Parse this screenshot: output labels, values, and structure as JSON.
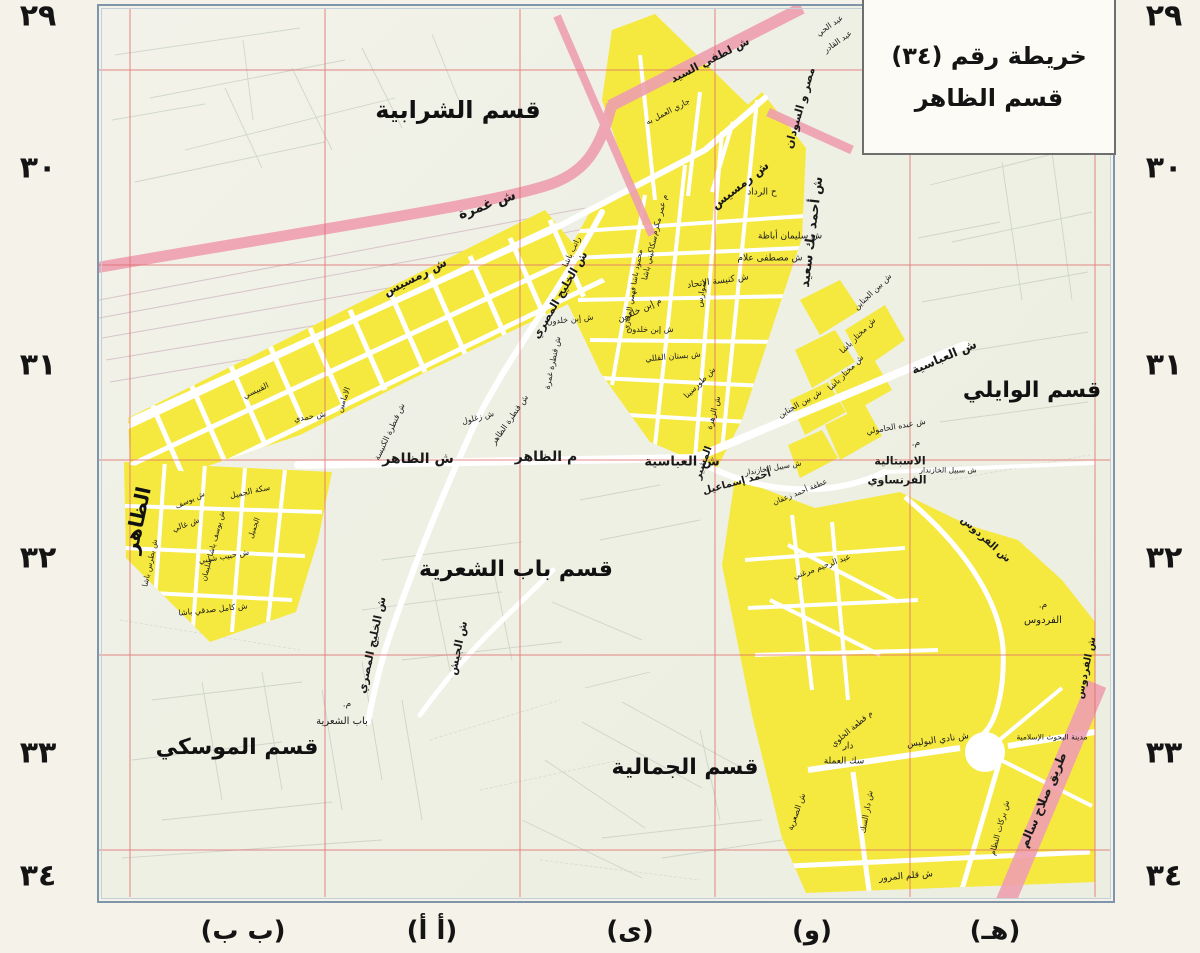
{
  "title_box": {
    "line1": "خريطة رقم (٣٤)",
    "line2": "قسم الظاهر"
  },
  "margins": {
    "left_numbers": [
      "٢٩",
      "٣٠",
      "٣١",
      "٣٢",
      "٣٣",
      "٣٤"
    ],
    "right_numbers": [
      "٢٩",
      "٣٠",
      "٣١",
      "٣٢",
      "٣٣",
      "٣٤"
    ],
    "row_y": [
      16,
      168,
      365,
      558,
      753,
      876
    ],
    "left_x": 38,
    "right_x": 1164,
    "bottom_letters": [
      "(ب ب)",
      "(أ أ)",
      "(ى)",
      "(و)",
      "(هـ)"
    ],
    "bottom_x": [
      243,
      432,
      630,
      812,
      995
    ],
    "bottom_y": 931
  },
  "colors": {
    "highlight_yellow": "#f5e93f",
    "road_pink": "#ee9fb0",
    "grid_red": "#e06a6a",
    "frame_blue": "#7f95aa",
    "map_background": "#edf0e4",
    "paper": "#f4f2e9"
  },
  "map": {
    "district_labels": [
      {
        "t": "قسم الشرابية",
        "x": 458,
        "y": 110,
        "r": 0,
        "s": 24
      },
      {
        "t": "قسم الوايلي",
        "x": 1032,
        "y": 391,
        "r": 0,
        "s": 22
      },
      {
        "t": "قسم باب الشعرية",
        "x": 516,
        "y": 570,
        "r": 0,
        "s": 22
      },
      {
        "t": "قسم الموسكي",
        "x": 237,
        "y": 748,
        "r": 0,
        "s": 22
      },
      {
        "t": "قسم الجمالية",
        "x": 685,
        "y": 768,
        "r": 0,
        "s": 22
      },
      {
        "t": "الظاهر",
        "x": 137,
        "y": 520,
        "r": -78,
        "s": 20
      }
    ],
    "street_labels": [
      {
        "t": "ش غمرة",
        "x": 487,
        "y": 205,
        "r": -20,
        "s": 14,
        "b": 1
      },
      {
        "t": "ش رمسيس",
        "x": 415,
        "y": 277,
        "r": -27,
        "s": 12,
        "b": 1
      },
      {
        "t": "ش رمسيس",
        "x": 740,
        "y": 185,
        "r": -38,
        "s": 12,
        "b": 1
      },
      {
        "t": "ش الخليج المصري",
        "x": 560,
        "y": 295,
        "r": -60,
        "s": 11,
        "b": 1
      },
      {
        "t": "ش الخليج المصري",
        "x": 372,
        "y": 645,
        "r": -78,
        "s": 11,
        "b": 1
      },
      {
        "t": "ش الجيش",
        "x": 458,
        "y": 648,
        "r": -78,
        "s": 11,
        "b": 1
      },
      {
        "t": "ش لطفي السيد",
        "x": 710,
        "y": 60,
        "r": -27,
        "s": 11,
        "b": 1
      },
      {
        "t": "جاري العمل به",
        "x": 668,
        "y": 112,
        "r": -27,
        "s": 8,
        "b": 0
      },
      {
        "t": "مصر و السودان",
        "x": 800,
        "y": 108,
        "r": -74,
        "s": 11,
        "b": 1
      },
      {
        "t": "عبد الحي",
        "x": 830,
        "y": 26,
        "r": -35,
        "s": 8,
        "b": 0
      },
      {
        "t": "عبد القادر",
        "x": 838,
        "y": 42,
        "r": -35,
        "s": 8,
        "b": 0
      },
      {
        "t": "ش أحمد بك سعيد",
        "x": 812,
        "y": 232,
        "r": -83,
        "s": 13,
        "b": 1
      },
      {
        "t": "ح الرداد",
        "x": 762,
        "y": 193,
        "r": 0,
        "s": 9,
        "b": 0
      },
      {
        "t": "ش سليمان أباظة",
        "x": 790,
        "y": 237,
        "r": 0,
        "s": 9,
        "b": 0
      },
      {
        "t": "ش مصطفى علام",
        "x": 770,
        "y": 259,
        "r": 0,
        "s": 9,
        "b": 0
      },
      {
        "t": "ش كنيسة الاتحاد",
        "x": 718,
        "y": 282,
        "r": -8,
        "s": 9,
        "b": 0
      },
      {
        "t": "سوارس",
        "x": 702,
        "y": 294,
        "r": -80,
        "s": 8,
        "b": 0
      },
      {
        "t": "م إبن خلدون",
        "x": 640,
        "y": 311,
        "r": -25,
        "s": 9,
        "b": 0
      },
      {
        "t": "ش إبن خلدون",
        "x": 570,
        "y": 320,
        "r": -6,
        "s": 8,
        "b": 0
      },
      {
        "t": "ش إبن خلدون",
        "x": 650,
        "y": 330,
        "r": 0,
        "s": 8,
        "b": 0
      },
      {
        "t": "ش بستان القللي",
        "x": 673,
        "y": 357,
        "r": -5,
        "s": 8,
        "b": 0
      },
      {
        "t": "ش طورسينا",
        "x": 700,
        "y": 383,
        "r": -45,
        "s": 8,
        "b": 0
      },
      {
        "t": "ش الزهرة",
        "x": 714,
        "y": 413,
        "r": -75,
        "s": 8,
        "b": 0
      },
      {
        "t": "م عمر مكرم",
        "x": 660,
        "y": 215,
        "r": -75,
        "s": 8,
        "b": 0
      },
      {
        "t": "سكاكيني باشا",
        "x": 650,
        "y": 258,
        "r": -77,
        "s": 8,
        "b": 0
      },
      {
        "t": "محمود باشا فهمي المعازي",
        "x": 633,
        "y": 290,
        "r": -80,
        "s": 7.5,
        "b": 0
      },
      {
        "t": "راتب باشا",
        "x": 572,
        "y": 252,
        "r": -65,
        "s": 8,
        "b": 0
      },
      {
        "t": "القبيسي",
        "x": 256,
        "y": 391,
        "r": -25,
        "s": 8,
        "b": 0
      },
      {
        "t": "الامامين",
        "x": 344,
        "y": 400,
        "r": -70,
        "s": 8,
        "b": 0
      },
      {
        "t": "ش حمدي",
        "x": 310,
        "y": 417,
        "r": -10,
        "s": 8,
        "b": 0
      },
      {
        "t": "ش قنطرة الكنيسة",
        "x": 390,
        "y": 432,
        "r": -65,
        "s": 8,
        "b": 0
      },
      {
        "t": "ش زغلول",
        "x": 478,
        "y": 418,
        "r": -15,
        "s": 8,
        "b": 0
      },
      {
        "t": "ش قنطرة الظاهر",
        "x": 510,
        "y": 420,
        "r": -55,
        "s": 8,
        "b": 0
      },
      {
        "t": "ش قنطرة غمرة",
        "x": 553,
        "y": 363,
        "r": -78,
        "s": 8,
        "b": 0
      },
      {
        "t": "ش الظاهر",
        "x": 418,
        "y": 459,
        "r": 0,
        "s": 14,
        "b": 1
      },
      {
        "t": "م الظاهر",
        "x": 546,
        "y": 457,
        "r": 0,
        "s": 14,
        "b": 1
      },
      {
        "t": "ش العباسية",
        "x": 682,
        "y": 462,
        "r": 0,
        "s": 13,
        "b": 1
      },
      {
        "t": "المشير",
        "x": 704,
        "y": 463,
        "r": -70,
        "s": 10,
        "b": 1
      },
      {
        "t": "أحمد إسماعيل",
        "x": 737,
        "y": 483,
        "r": -15,
        "s": 10,
        "b": 1
      },
      {
        "t": "ش بين الجناين",
        "x": 873,
        "y": 292,
        "r": -44,
        "s": 8,
        "b": 0
      },
      {
        "t": "ش بين الجناين",
        "x": 800,
        "y": 404,
        "r": -30,
        "s": 8,
        "b": 0
      },
      {
        "t": "ش مختار باشا",
        "x": 858,
        "y": 336,
        "r": -45,
        "s": 8,
        "b": 0
      },
      {
        "t": "ش مختار باشا",
        "x": 846,
        "y": 373,
        "r": -45,
        "s": 8,
        "b": 0
      },
      {
        "t": "ش عبده الحامولي",
        "x": 896,
        "y": 427,
        "r": -10,
        "s": 8,
        "b": 0
      },
      {
        "t": "ش العباسية",
        "x": 944,
        "y": 357,
        "r": -23,
        "s": 12,
        "b": 1
      },
      {
        "t": "م.",
        "x": 916,
        "y": 444,
        "r": 0,
        "s": 9,
        "b": 0
      },
      {
        "t": "الاسبتالية",
        "x": 900,
        "y": 461,
        "r": 0,
        "s": 11,
        "b": 1
      },
      {
        "t": "الفرنساوي",
        "x": 897,
        "y": 480,
        "r": 0,
        "s": 11,
        "b": 1
      },
      {
        "t": "ش سبيل الخازندار",
        "x": 948,
        "y": 470,
        "r": 0,
        "s": 7.5,
        "b": 0
      },
      {
        "t": "ش سبيل الخازندار",
        "x": 773,
        "y": 468,
        "r": -10,
        "s": 7.5,
        "b": 0
      },
      {
        "t": "عطفة أحمد زعفان",
        "x": 800,
        "y": 492,
        "r": -22,
        "s": 7.5,
        "b": 0
      },
      {
        "t": "ش الفردوس",
        "x": 985,
        "y": 540,
        "r": 42,
        "s": 10,
        "b": 1
      },
      {
        "t": "م.",
        "x": 1043,
        "y": 606,
        "r": 0,
        "s": 9,
        "b": 0
      },
      {
        "t": "الفردوس",
        "x": 1043,
        "y": 621,
        "r": 0,
        "s": 10,
        "b": 0
      },
      {
        "t": "ش الفردوس",
        "x": 1087,
        "y": 668,
        "r": -78,
        "s": 10,
        "b": 1
      },
      {
        "t": "عبد الرحيم مرغني",
        "x": 822,
        "y": 567,
        "r": -20,
        "s": 8,
        "b": 0
      },
      {
        "t": "م قطعة الخلوي",
        "x": 852,
        "y": 729,
        "r": -40,
        "s": 8,
        "b": 0
      },
      {
        "t": "دار",
        "x": 848,
        "y": 747,
        "r": 0,
        "s": 9,
        "b": 0
      },
      {
        "t": "سك العملة",
        "x": 844,
        "y": 762,
        "r": 0,
        "s": 9,
        "b": 0
      },
      {
        "t": "ش نادي البوليس",
        "x": 938,
        "y": 741,
        "r": -8,
        "s": 9,
        "b": 0
      },
      {
        "t": "مدينة البحوث الإسلامية",
        "x": 1052,
        "y": 737,
        "r": 0,
        "s": 7.5,
        "b": 0
      },
      {
        "t": "ش دار السك",
        "x": 867,
        "y": 812,
        "r": -80,
        "s": 8,
        "b": 0
      },
      {
        "t": "ش بركات النظام",
        "x": 1000,
        "y": 828,
        "r": -75,
        "s": 8,
        "b": 0
      },
      {
        "t": "ش قلم المرور",
        "x": 906,
        "y": 877,
        "r": -5,
        "s": 9,
        "b": 0
      },
      {
        "t": "ش الصعرية",
        "x": 797,
        "y": 812,
        "r": -70,
        "s": 8,
        "b": 0
      },
      {
        "t": "طريق صلاح سالم",
        "x": 1043,
        "y": 800,
        "r": -67,
        "s": 12,
        "b": 1
      },
      {
        "t": "م.",
        "x": 347,
        "y": 705,
        "r": 0,
        "s": 9,
        "b": 0
      },
      {
        "t": "باب الشعرية",
        "x": 342,
        "y": 722,
        "r": 0,
        "s": 10,
        "b": 0
      },
      {
        "t": "سكة الجميل",
        "x": 250,
        "y": 492,
        "r": -12,
        "s": 8,
        "b": 0
      },
      {
        "t": "ش يوسف",
        "x": 190,
        "y": 500,
        "r": -25,
        "s": 7.5,
        "b": 0
      },
      {
        "t": "ش يوسف باشا سليمان",
        "x": 213,
        "y": 546,
        "r": -75,
        "s": 7.5,
        "b": 0
      },
      {
        "t": "ش غالي",
        "x": 186,
        "y": 525,
        "r": -20,
        "s": 8,
        "b": 0
      },
      {
        "t": "ش حبيب شلبي",
        "x": 224,
        "y": 557,
        "r": -10,
        "s": 8,
        "b": 0
      },
      {
        "t": "ش بطرس باشا",
        "x": 150,
        "y": 563,
        "r": -78,
        "s": 7.5,
        "b": 0
      },
      {
        "t": "ش كامل صدقي باشا",
        "x": 213,
        "y": 610,
        "r": -6,
        "s": 8,
        "b": 0
      },
      {
        "t": "الجميل",
        "x": 254,
        "y": 528,
        "r": -70,
        "s": 7.5,
        "b": 0
      }
    ]
  }
}
